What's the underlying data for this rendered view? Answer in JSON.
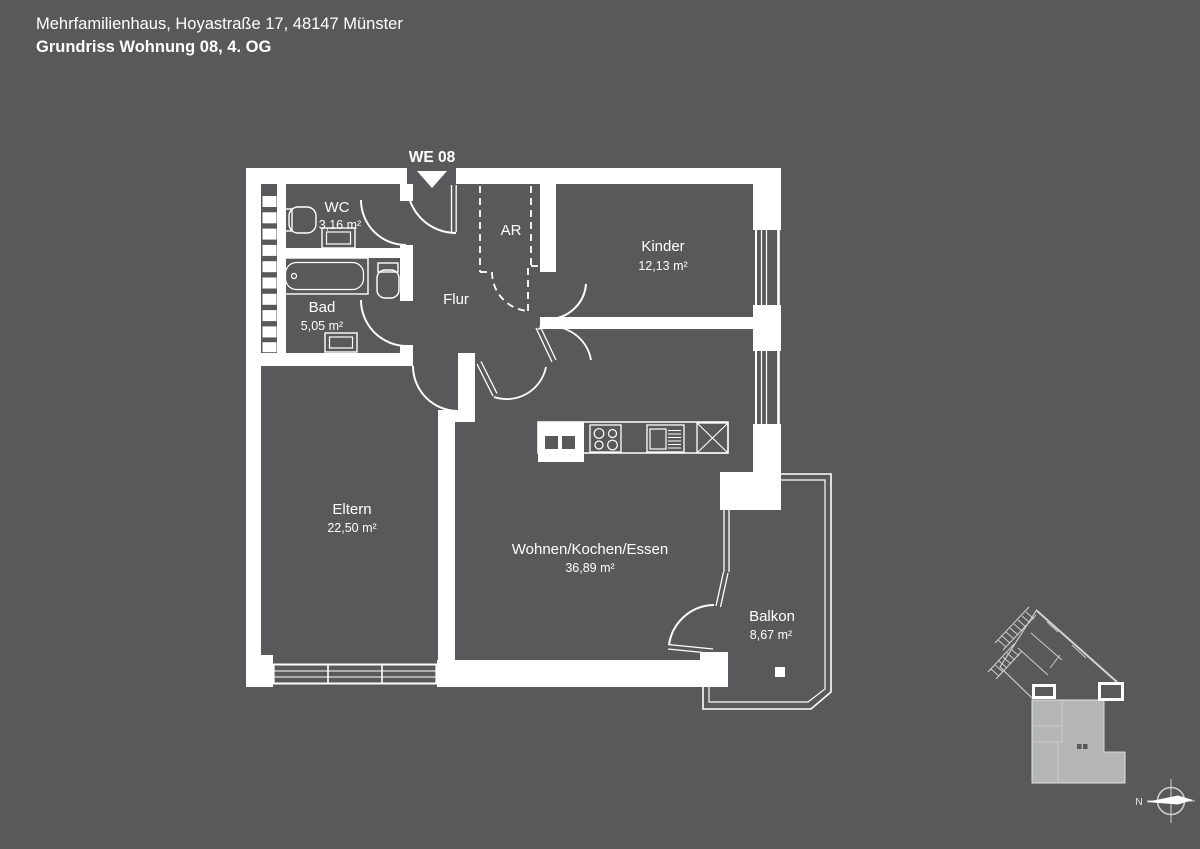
{
  "header": {
    "line1": "Mehrfamilienhaus, Hoyastraße 17, 48147 Münster",
    "line2": "Grundriss Wohnung 08, 4. OG"
  },
  "unit_label": "WE 08",
  "rooms": {
    "wc": {
      "name": "WC",
      "area": "3,16 m²"
    },
    "bad": {
      "name": "Bad",
      "area": "5,05 m²"
    },
    "flur": {
      "name": "Flur",
      "area": ""
    },
    "ar": {
      "name": "AR",
      "area": ""
    },
    "kinder": {
      "name": "Kinder",
      "area": "12,13 m²"
    },
    "eltern": {
      "name": "Eltern",
      "area": "22,50 m²"
    },
    "wohnen": {
      "name": "Wohnen/Kochen/Essen",
      "area": "36,89 m²"
    },
    "balkon": {
      "name": "Balkon",
      "area": "8,67 m²"
    }
  },
  "compass": {
    "north_label": "N"
  },
  "colors": {
    "background": "#59585b",
    "line": "#ffffff",
    "minimap_unit_fill": "#b4b5b7",
    "minimap_line": "#d2d3d5"
  }
}
